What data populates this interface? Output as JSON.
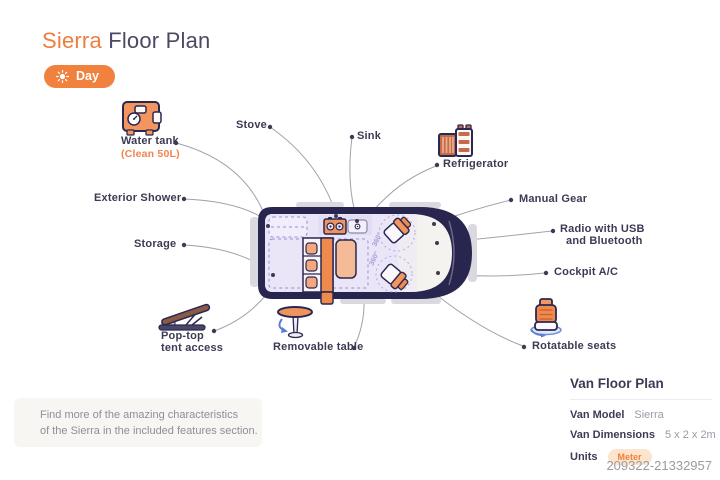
{
  "header": {
    "title_accent": "Sierra",
    "title_rest": "Floor Plan",
    "mode_toggle": {
      "label": "Day",
      "icon": "sun-icon"
    }
  },
  "features": {
    "water_tank": {
      "label": "Water tank",
      "sublabel": "(Clean 50L)",
      "icon": "water-tank-icon"
    },
    "stove": {
      "label": "Stove"
    },
    "sink": {
      "label": "Sink"
    },
    "refrigerator": {
      "label": "Refrigerator",
      "icon": "refrigerator-icon"
    },
    "exterior_shower": {
      "label": "Exterior Shower"
    },
    "storage": {
      "label": "Storage"
    },
    "manual_gear": {
      "label": "Manual Gear"
    },
    "radio": {
      "label_line1": "Radio with USB",
      "label_line2": "and Bluetooth"
    },
    "cockpit_ac": {
      "label": "Cockpit A/C"
    },
    "pop_top": {
      "label_line1": "Pop-top",
      "label_line2": "tent access",
      "icon": "pop-top-tent-icon"
    },
    "removable_table": {
      "label": "Removable table",
      "icon": "removable-table-icon"
    },
    "rotatable_seats": {
      "label": "Rotatable seats",
      "icon": "rotatable-seat-icon"
    }
  },
  "diagram": {
    "seat_rotation_label": "360°"
  },
  "note": {
    "line1": "Find more of the amazing characteristics",
    "line2": "of the Sierra in the included features section."
  },
  "info_panel": {
    "title": "Van Floor Plan",
    "rows": [
      {
        "label": "Van Model",
        "value": "Sierra"
      },
      {
        "label": "Van Dimensions",
        "value": "5 x 2 x 2m"
      },
      {
        "label": "Units",
        "value": "Meter"
      }
    ]
  },
  "watermark": "209322-21332957",
  "colors": {
    "accent": "#F0813E",
    "navy_text": "#3D3B54",
    "van_body": "#28264F",
    "lavender": "#EAE6F8",
    "lavender_stroke": "#9A8FD6",
    "leader": "#A3A1AE",
    "seat_orange": "#F2955F",
    "badge_bg": "#FDE4CC",
    "badge_text": "#F0803D",
    "muted": "#9B99A6"
  }
}
